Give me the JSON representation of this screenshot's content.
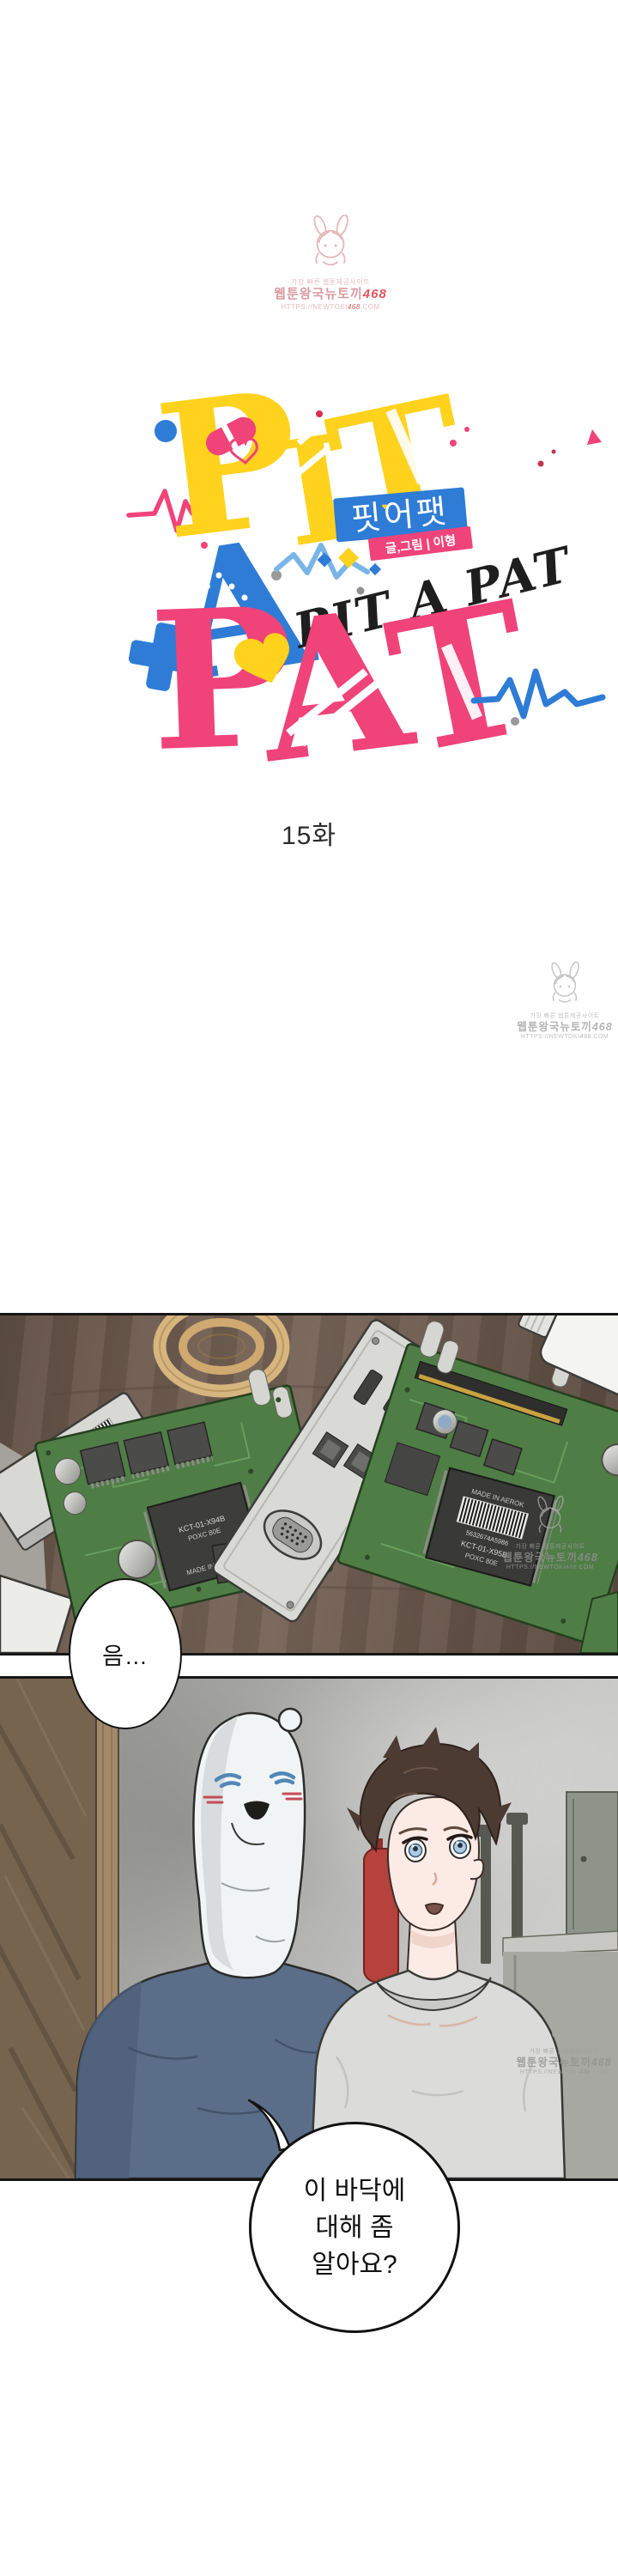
{
  "watermark": {
    "line1": "가장 빠른 웹툰제공사이트",
    "line2_prefix": "웹툰왕국뉴토끼",
    "line2_num": "468",
    "line3_prefix": "HTTPS://NEWTOKI",
    "line3_num": "468",
    "line3_suffix": ".COM",
    "accent_red": "#e0575c",
    "pink": "#e7b9bc",
    "gray": "#c6c6c6"
  },
  "title_logo": {
    "letter_p": "P",
    "letter_i": "I",
    "letter_t": "T",
    "word_mid": "A",
    "bottom_p": "P",
    "bottom_a": "A",
    "bottom_t": "T",
    "script": "PIT A PAT",
    "korean_badge": "핏어팻",
    "badge_heart": "♥",
    "credit_badge": "글,그림 | 이형",
    "colors": {
      "yellow": "#ffd21e",
      "pink": "#f0437a",
      "blue": "#2e7cd6",
      "light_blue": "#79b5e9",
      "script_black": "#1e1e1e"
    }
  },
  "episode": {
    "label": "15화"
  },
  "panel1": {
    "chip_made_in": "MADE IN AEROK",
    "chip_model_a": "KCT-01-X94B",
    "chip_spec_a": "POXC 80E",
    "chip_model_b": "KCT-01-X95B",
    "chip_spec_b": "POXC 80E",
    "chip_model_c": "PCT-08-ARQ-02",
    "chip_spec_c": "KDXT 40E",
    "barcode_digits": "5632674A5986"
  },
  "speech": {
    "bubble1": "음…",
    "bubble2_line1": "이 바닥에",
    "bubble2_line2": "대해 좀",
    "bubble2_line3": "알아요?"
  }
}
